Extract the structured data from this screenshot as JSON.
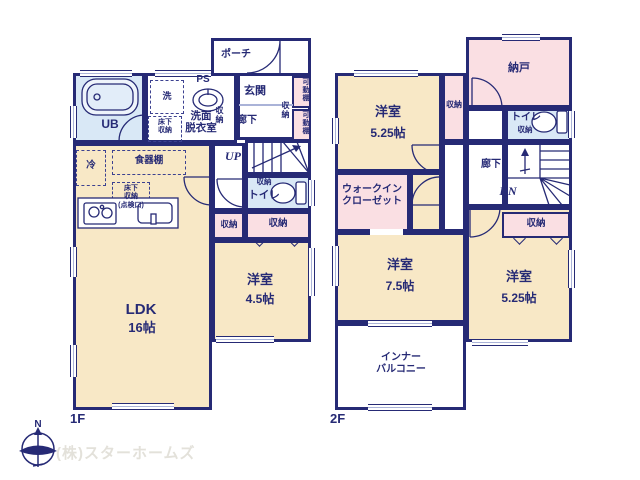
{
  "colors": {
    "wall": "#262a75",
    "room_cream": "#f8e8c6",
    "closet_pink": "#fadfe3",
    "bath_blue": "#d9e8f6",
    "window_line": "#aab3d8",
    "logo_text": "#e3e1da"
  },
  "common": {
    "storage": "収納",
    "toilet": "トイレ",
    "hallway": "廊下",
    "western_room": "洋室"
  },
  "floor1": {
    "label": "1F",
    "porch": "ポーチ",
    "entrance": "玄関",
    "up": "UP",
    "unit_bath": "UB",
    "washer": "洗",
    "pipe_space": "PS",
    "washroom_line1": "洗面",
    "washroom_line2": "脱衣室",
    "underfloor_line1": "床下",
    "underfloor_line2": "収納",
    "fridge": "冷",
    "cupboard": "食器棚",
    "kitchen_underfloor_line1": "床下",
    "kitchen_underfloor_line2": "収納",
    "kitchen_underfloor_line3": "(点検口)",
    "movable_shelf": "可動棚",
    "ldk": "LDK",
    "ldk_size": "16帖",
    "room45_size": "4.5帖"
  },
  "floor2": {
    "label": "2F",
    "storeroom": "納戸",
    "dn": "DN",
    "wic_line1": "ウォークイン",
    "wic_line2": "クローゼット",
    "room525a_size": "5.25帖",
    "room75_size": "7.5帖",
    "room525b_size": "5.25帖",
    "balcony_line1": "インナー",
    "balcony_line2": "バルコニー"
  },
  "footer": {
    "company": "(株)スターホームズ",
    "compass_north": "N"
  }
}
